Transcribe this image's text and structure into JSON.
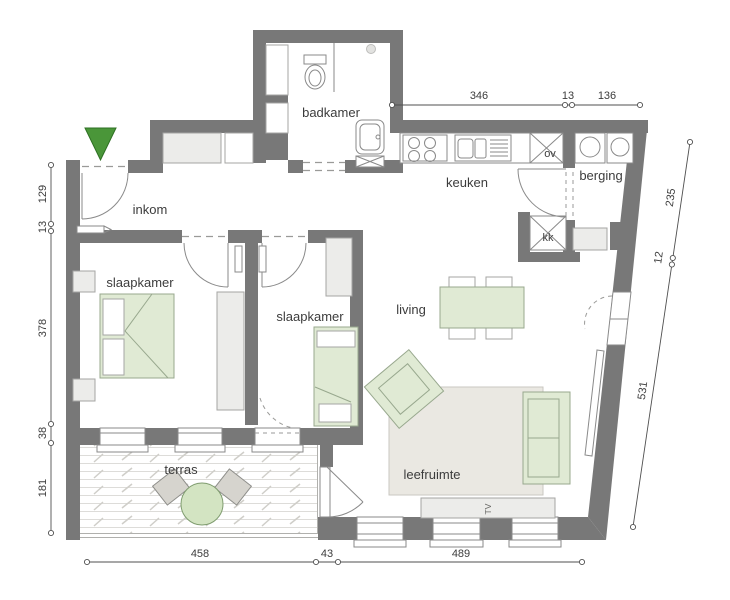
{
  "rooms": {
    "inkom": {
      "label": "inkom"
    },
    "badkamer": {
      "label": "badkamer"
    },
    "keuken": {
      "label": "keuken"
    },
    "berging": {
      "label": "berging"
    },
    "slaapkamer_1": {
      "label": "slaapkamer"
    },
    "slaapkamer_2": {
      "label": "slaapkamer"
    },
    "living": {
      "label": "living"
    },
    "leefruimte": {
      "label": "leefruimte"
    },
    "terras": {
      "label": "terras"
    }
  },
  "fixtures": {
    "oven": "ov",
    "koelkast": "kk",
    "tv": "TV"
  },
  "dimensions": {
    "top": [
      "346",
      "13",
      "136"
    ],
    "left": [
      "129",
      "13",
      "378",
      "38",
      "181"
    ],
    "right": [
      "235",
      "12",
      "531"
    ],
    "bottom": [
      "458",
      "43",
      "489"
    ]
  },
  "colors": {
    "wall": "#787878",
    "furniture_green": "#e0ead4",
    "entrance_marker_green": "#4a9639",
    "rug": "#eae8e2",
    "dimension_line": "#4f4f4f"
  }
}
